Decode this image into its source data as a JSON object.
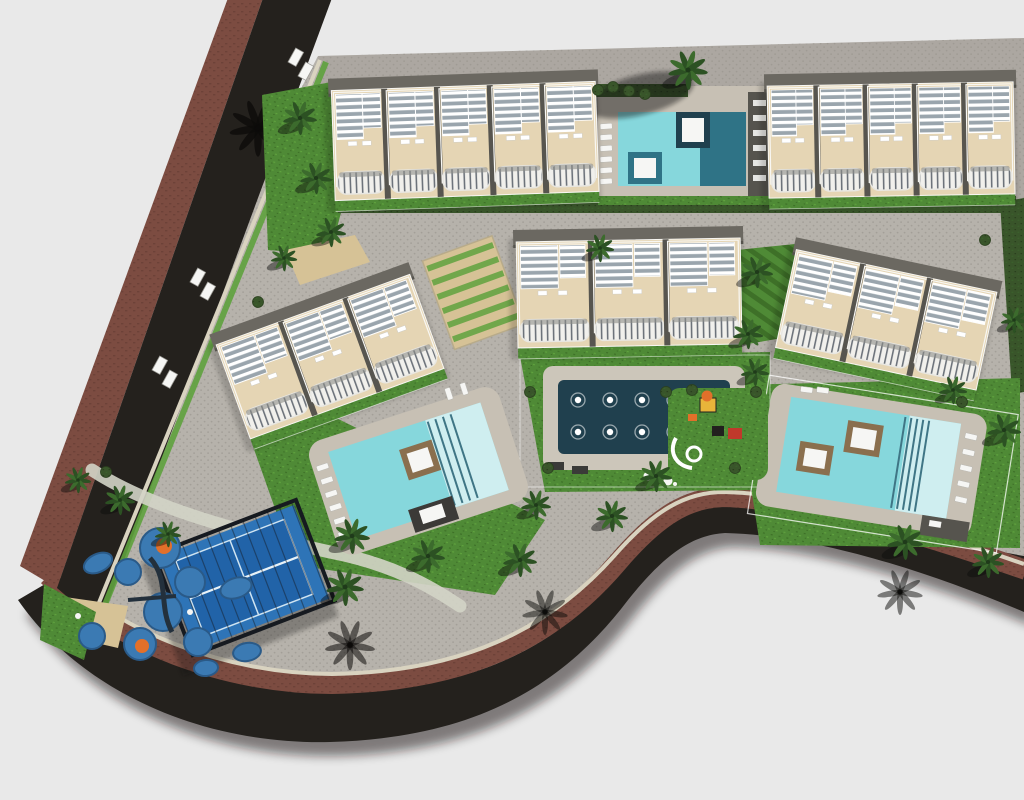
{
  "scene": {
    "name": "residential-complex-aerial-site-plan",
    "view": "top-down 3d architectural render",
    "amenities": [
      {
        "name": "residential-building",
        "count": 5
      },
      {
        "name": "swimming-pool",
        "count": 3
      },
      {
        "name": "ornamental-fountain-pool",
        "count": 1
      },
      {
        "name": "padel-court",
        "count": 1
      },
      {
        "name": "children-playground",
        "count": 2
      },
      {
        "name": "palm-tree",
        "count": 24
      },
      {
        "name": "perimeter-road",
        "count": 2
      }
    ]
  },
  "colors": {
    "background": "#e9e9e9",
    "paving": "#b6b2ab",
    "paving_dot": "#a39f98",
    "paving_top_tint": "#97938c",
    "asphalt": "#24211d",
    "asphalt_shadow": "#121110",
    "sidewalk_brick": "#7c4c41",
    "curb": "#d9d3c0",
    "lawn": "#4f8a36",
    "lawn_dark": "#3e7028",
    "lawn_light": "#5fa23e",
    "hedge": "#39552a",
    "hedge_dark": "#2a3f1e",
    "palm": "#2c5123",
    "palm_dark": "#1f3a1a",
    "palm_light": "#3c6b2d",
    "palm_shadow": "#0c0b0a",
    "building_cream": "#e5d5b4",
    "building_frame": "#f8f7f3",
    "roof_gray": "#6b6861",
    "roof_dark": "#55534d",
    "divider": "#57554f",
    "pergola_base": "#9aa5ad",
    "railing_slat": "#6d737b",
    "balcony_white": "#f1f0ec",
    "deck": "#c7c0b4",
    "deck_light": "#ccc6ba",
    "platform_dark": "#56544e",
    "pool": "#86d7dc",
    "pool_light": "#cfeef0",
    "pool_deep": "#2f7386",
    "step_line": "#3f7585",
    "orn_pool": "#20404e",
    "bed_brown": "#8a6f4e",
    "white": "#f6f6f4",
    "court_blue": "#2e74b7",
    "court_inner": "#2163a8",
    "court_line": "#cfe4f2",
    "cage": "#161a20",
    "play_blue": "#3b7ab3",
    "play_blue_dark": "#2a5a88",
    "play_orange": "#e2702a",
    "play_red": "#c0392b",
    "play_yellow": "#e8b43a",
    "play_black": "#22201e",
    "tan": "#d6c296"
  }
}
